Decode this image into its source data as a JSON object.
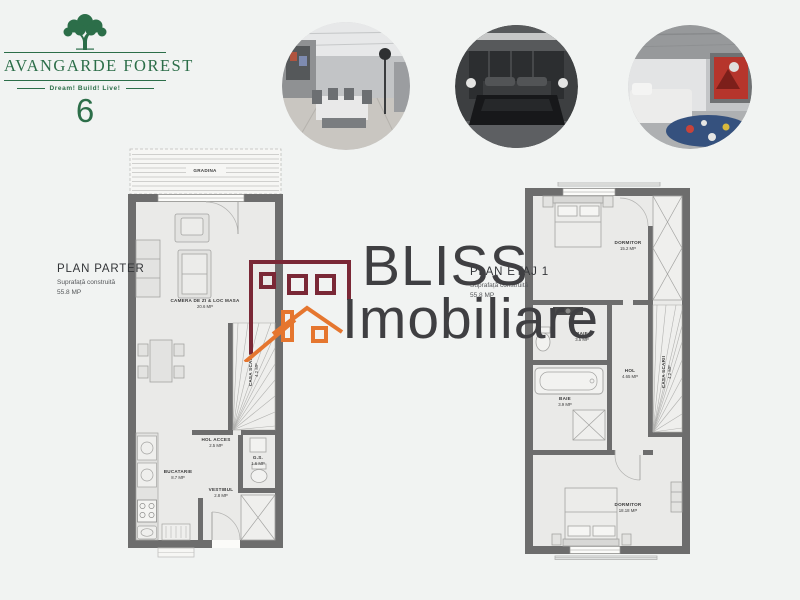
{
  "colors": {
    "background": "#f1f3f2",
    "brand_green": "#2c6e49",
    "wall_gray": "#6d6d6d",
    "floor": "#eaeae8",
    "watermark_text": "#3f3f42",
    "watermark_building": "#7a2836",
    "watermark_roof": "#e5762f"
  },
  "logo": {
    "title": "AVANGARDE FOREST",
    "tagline": "Dream! Build! Live!",
    "number": "6",
    "icon": "tree-icon"
  },
  "photos": [
    {
      "name": "living-room-render"
    },
    {
      "name": "bedroom-render"
    },
    {
      "name": "kids-room-render"
    }
  ],
  "watermark": {
    "line1": "BLISS",
    "line2": "Imobiliare"
  },
  "parter": {
    "title": "PLAN PARTER",
    "subtitle": "Suprafață construită",
    "area": "55.8 MP",
    "rooms": [
      {
        "label": "GRADINA",
        "area": ""
      },
      {
        "label": "CAMERA DE ZI & LOC MASA",
        "area": "20.6 MP"
      },
      {
        "label": "CASA SCARII",
        "area": "4.2 MP"
      },
      {
        "label": "HOL ACCES",
        "area": "2.5 MP"
      },
      {
        "label": "G.S.",
        "area": "1.6 MP"
      },
      {
        "label": "BUCATARIE",
        "area": "8.7 MP"
      },
      {
        "label": "VESTIBUL",
        "area": "2.8 MP"
      }
    ]
  },
  "etaj": {
    "title": "PLAN ETAJ 1",
    "subtitle": "Suprafață construită",
    "area": "55.8 MP",
    "rooms": [
      {
        "label": "DORMITOR",
        "area": "15.2 MP"
      },
      {
        "label": "BAIE",
        "area": "3.5 MP"
      },
      {
        "label": "HOL",
        "area": "4.65 MP"
      },
      {
        "label": "BAIE",
        "area": "3.9 MP"
      },
      {
        "label": "CASA SCARII",
        "area": "4.2 MP"
      },
      {
        "label": "DORMITOR",
        "area": "18.18 MP"
      }
    ]
  }
}
